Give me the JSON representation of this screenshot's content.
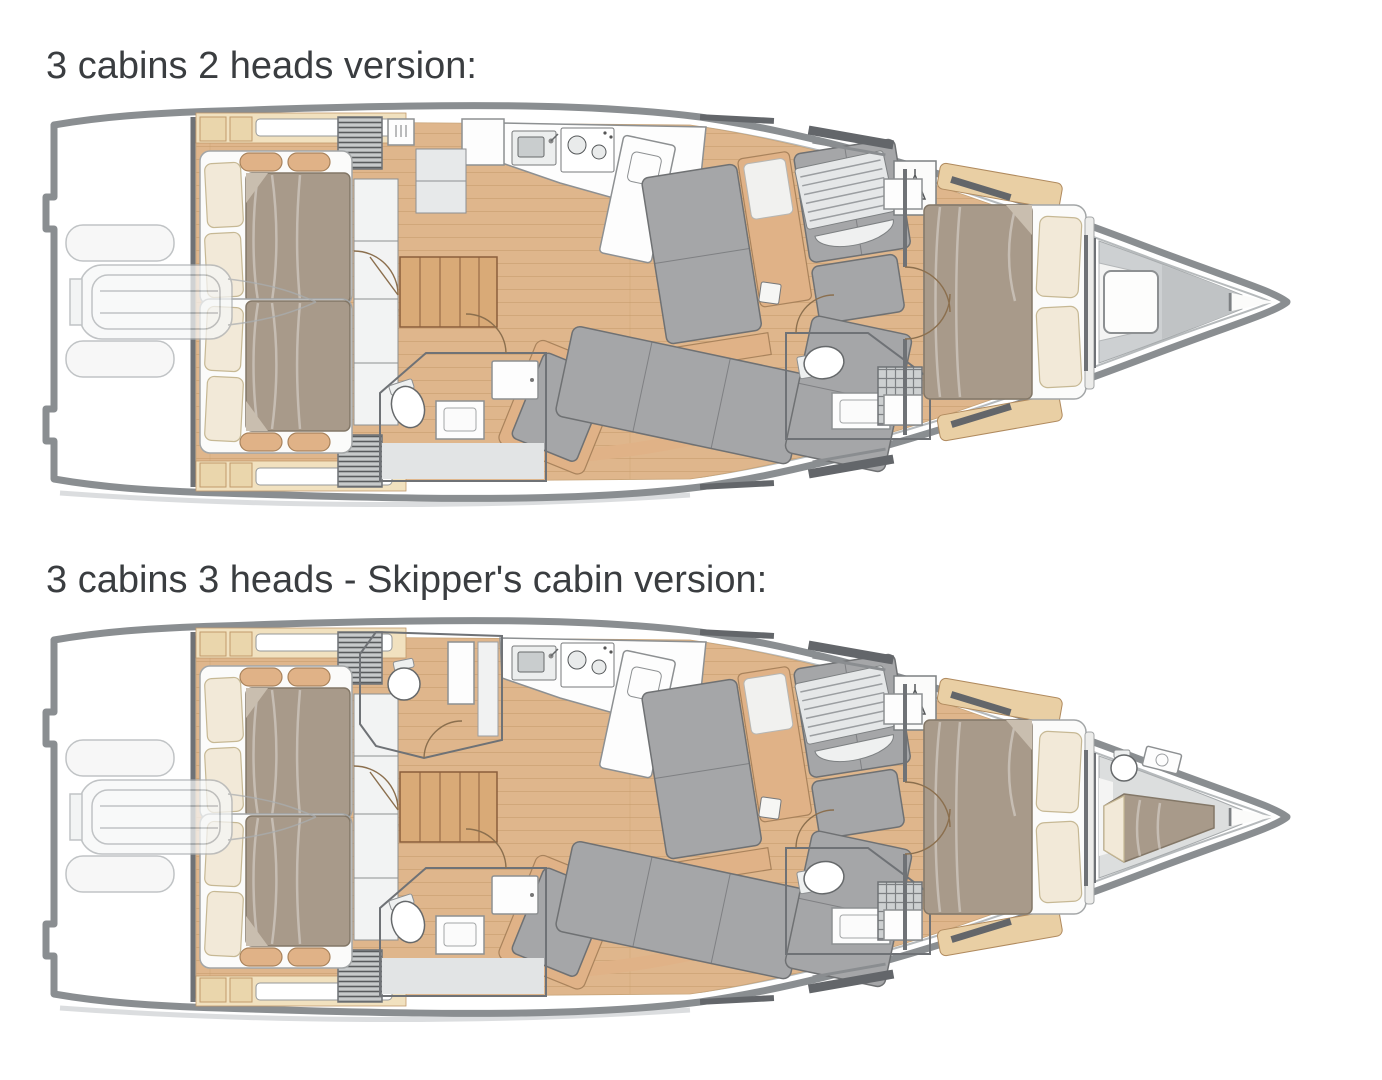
{
  "titles": {
    "plan1": "3 cabins 2 heads version:",
    "plan2": "3 cabins 3 heads - Skipper's cabin version:"
  },
  "colors": {
    "hull": "#8a8e91",
    "wall": "#6f7276",
    "wood": "#dfb68c",
    "plank": "#c49767",
    "trim": "#e0b287",
    "duvet": "#a89a8a",
    "pillow": "#f2e9d8",
    "cushion": "#a5a6a8",
    "floor": "#d7d9da",
    "title": "#3a3d40"
  },
  "plans": [
    {
      "title": "3 cabins 2 heads version:",
      "cabins": 3,
      "heads": 2,
      "compartments": [
        "swim platform with tender",
        "port aft double cabin",
        "starboard aft double cabin",
        "aft starboard head with shower",
        "galley with sink and stove",
        "companionway stairs",
        "saloon settees",
        "mid starboard head with shower",
        "forward owner cabin with double berth",
        "sail locker",
        "bow anchor locker"
      ]
    },
    {
      "title": "3 cabins 3 heads - Skipper's cabin version:",
      "cabins": 3,
      "heads": 3,
      "compartments": [
        "swim platform with tender",
        "port aft double cabin",
        "starboard aft double cabin",
        "aft starboard head with shower",
        "port head",
        "galley with sink and stove",
        "companionway stairs",
        "saloon settees",
        "mid starboard head with shower",
        "forward owner cabin with double berth",
        "skipper cabin with berth and toilet",
        "bow anchor locker"
      ]
    }
  ]
}
